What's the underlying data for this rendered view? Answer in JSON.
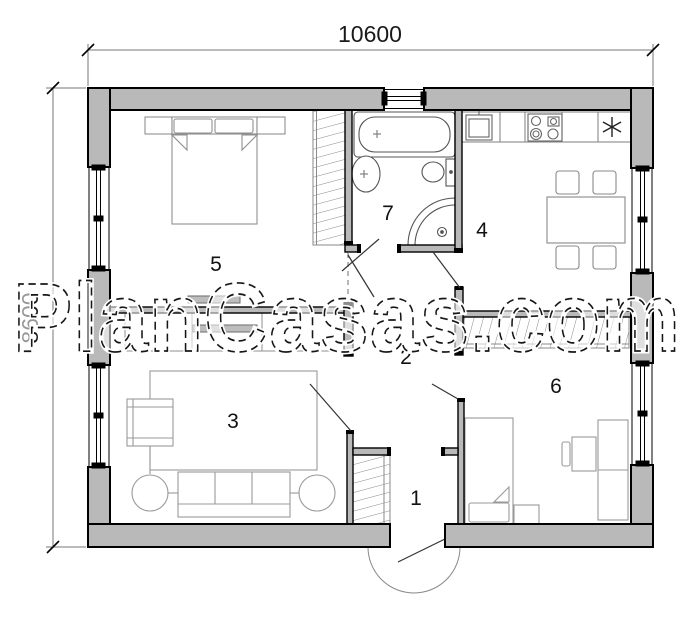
{
  "watermark": {
    "text": "PlanCasas.com"
  },
  "dimensions": {
    "top": "10600",
    "left": "8600"
  },
  "rooms": {
    "r1": {
      "number": "1"
    },
    "r2": {
      "number": "2"
    },
    "r3": {
      "number": "3"
    },
    "r4": {
      "number": "4"
    },
    "r5": {
      "number": "5"
    },
    "r6": {
      "number": "6"
    },
    "r7": {
      "number": "7"
    }
  },
  "icons": {
    "fridge": "six-spoke-asterisk",
    "tub_faucet": "small-cross",
    "basin_faucet": "small-cross",
    "shower_drain": "circle-with-dot"
  },
  "colors": {
    "wall_fill": "#b9b9b9",
    "wall_line": "#000000",
    "furniture_line": "#999999",
    "fixture_line": "#555555",
    "dim_line": "#777777"
  }
}
